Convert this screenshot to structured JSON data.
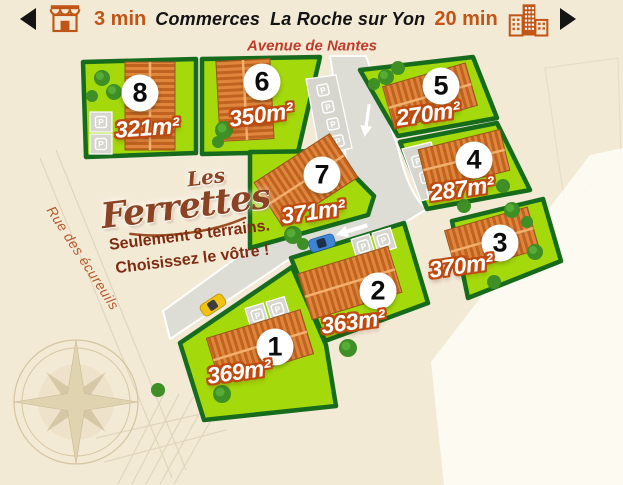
{
  "header": {
    "left_time": "3 min",
    "left_label": "Commerces",
    "right_label": "La Roche sur Yon",
    "right_time": "20 min"
  },
  "streets": {
    "top": "Avenue de Nantes",
    "side": "Rue des écureuils"
  },
  "logo": {
    "line1": "Les",
    "line2": "Ferrettes"
  },
  "promo": {
    "line1": "Seulement 8 terrains.",
    "line2": "Choisissez le vôtre !"
  },
  "map": {
    "parking_label": "P"
  },
  "plots": [
    {
      "number": "1",
      "area": "369m²"
    },
    {
      "number": "2",
      "area": "363m²"
    },
    {
      "number": "3",
      "area": "370m²"
    },
    {
      "number": "4",
      "area": "287m²"
    },
    {
      "number": "5",
      "area": "270m²"
    },
    {
      "number": "6",
      "area": "350m²"
    },
    {
      "number": "7",
      "area": "371m²"
    },
    {
      "number": "8",
      "area": "321m²"
    }
  ],
  "icons": {
    "left_nav": "arrow-left-icon",
    "shop": "storefront-icon",
    "city": "city-buildings-icon",
    "right_nav": "arrow-right-icon",
    "compass": "compass-rose-icon"
  },
  "colors": {
    "background": "#f3ead6",
    "accent_orange": "#c05515",
    "plot_green": "#a4d90b",
    "plot_border": "#176b1d",
    "area_label_outline": "#bf4a10",
    "street_label_red": "#c13b2a",
    "logo_brown": "#8a4423",
    "road_gray": "#dcdcd5"
  }
}
